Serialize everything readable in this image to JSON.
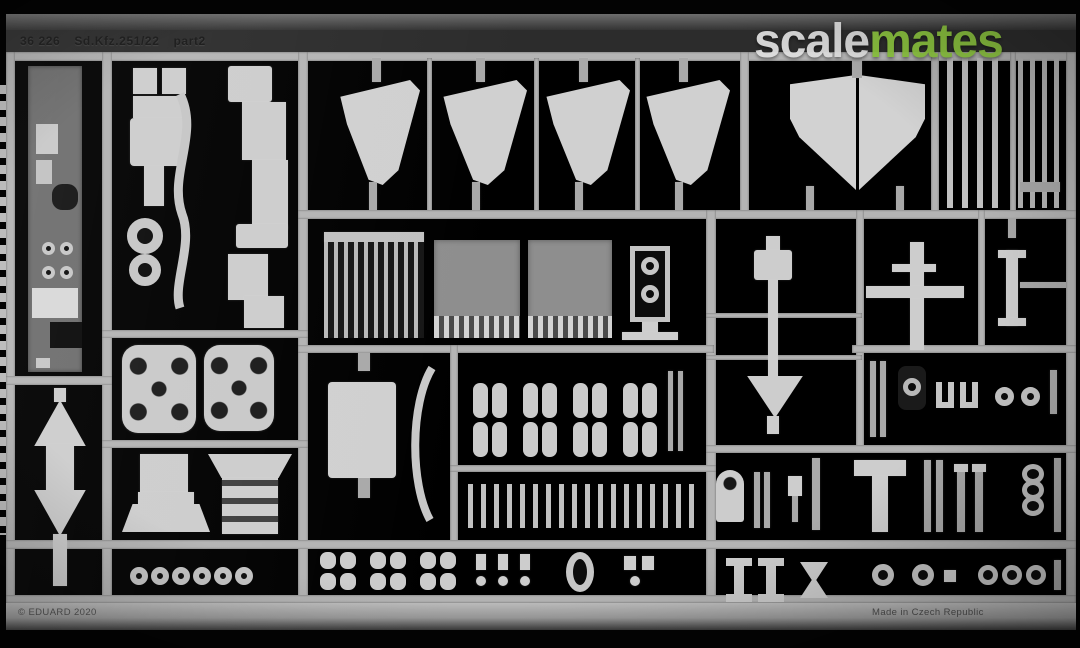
{
  "meta": {
    "description": "Product photograph of a photo-etched brass detail fret for a scale model kit, dark background, watermark top right"
  },
  "watermark": {
    "gray_part": "scale",
    "green_part": "mates"
  },
  "fret": {
    "header_code": "36 226",
    "header_title": "Sd.Kfz.251/22",
    "header_suffix": "part2",
    "copyright": "© EDUARD 2020",
    "made_in": "Made in Czech Republic"
  },
  "colors": {
    "background": "#000000",
    "metal_light": "#cdcdcd",
    "frame_rail": "#b4b4b4",
    "plate_gray": "#8e8e8e",
    "watermark_green": "#8dc63f",
    "watermark_gray": "#dedede"
  }
}
